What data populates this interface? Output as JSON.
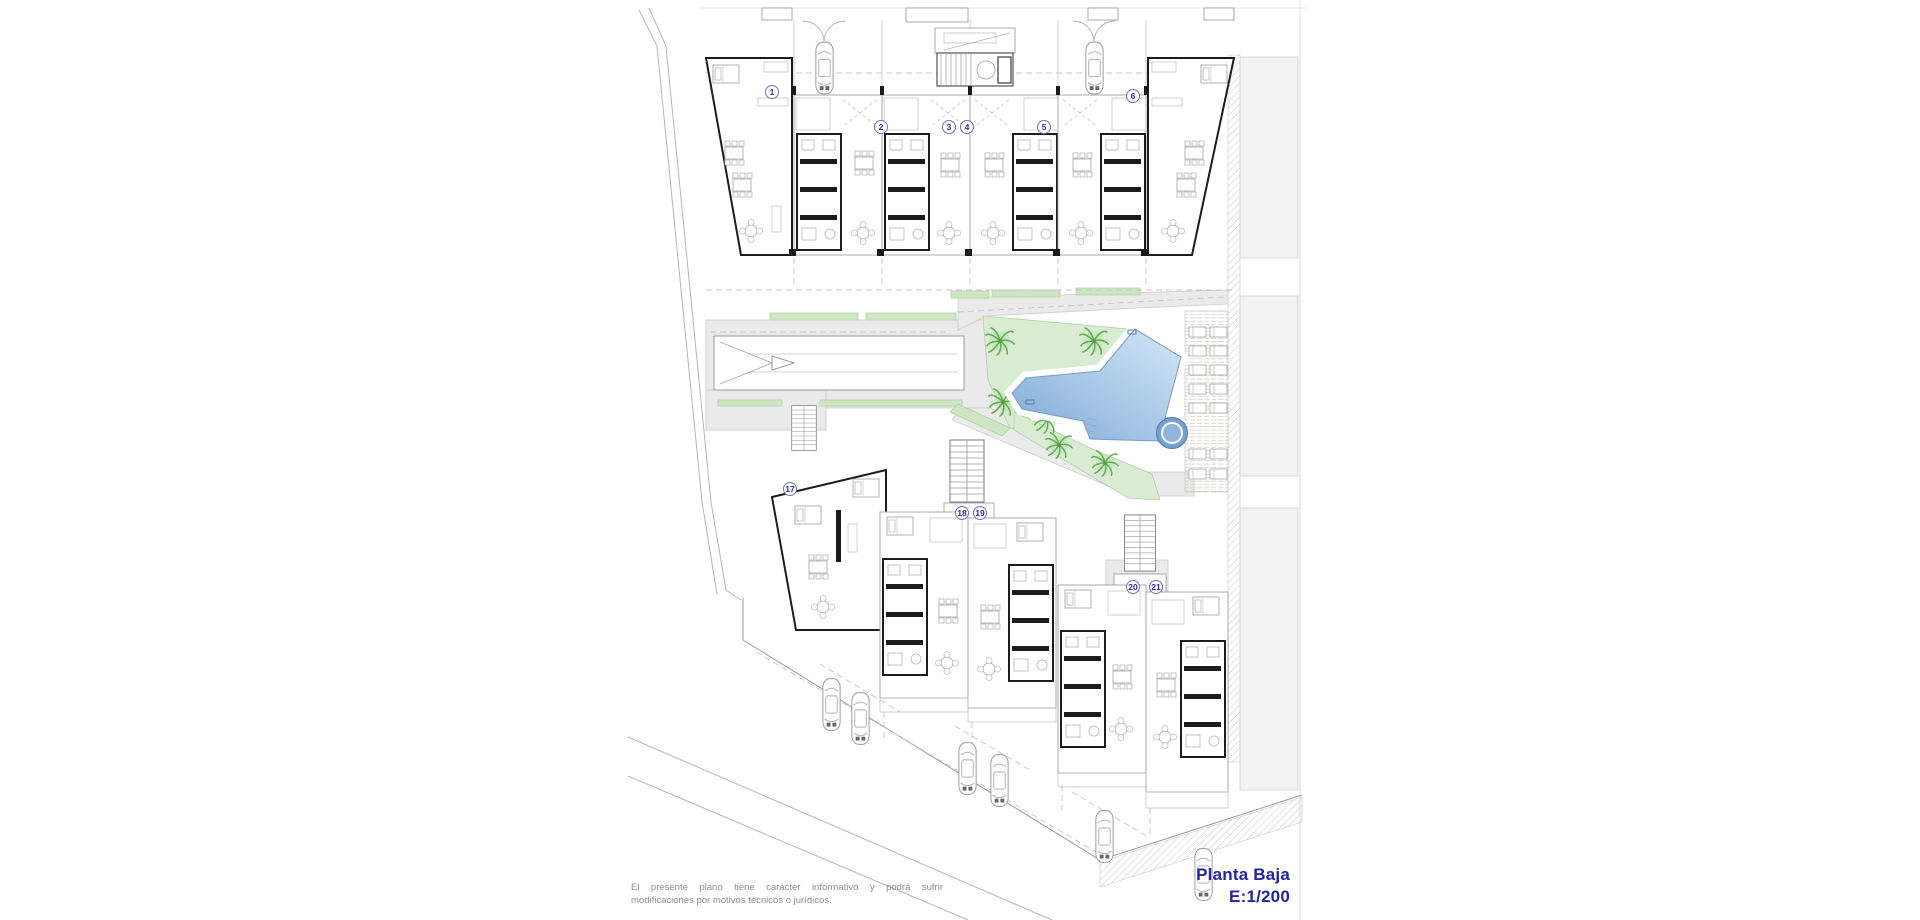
{
  "sheet": {
    "plan_title": "Planta Baja",
    "plan_scale": "E:1/200",
    "disclaimer_line1": "El presente plano tiene carácter informativo y podrá sufrir",
    "disclaimer_line2": "modificaciones por motivos técnicos o jurídicos.",
    "title_color": "#2323a3",
    "disclaimer_color": "#8d8d8d"
  },
  "units": {
    "top_row": [
      "1",
      "2",
      "3",
      "4",
      "5",
      "6"
    ],
    "bottom_row": [
      "17",
      "18",
      "19",
      "20",
      "21"
    ]
  },
  "site": {
    "feature_icons": [
      "swimming-pool",
      "round-spa",
      "sunbathing-deck",
      "garage-ramp",
      "palm-tree",
      "car",
      "staircase",
      "parking-row"
    ],
    "colors": {
      "pool_deep": "#74a3d2",
      "pool_light": "#d3e6f6",
      "landscape_green": "#d9ecd2",
      "strip_green": "#cfe6c4",
      "palm_green": "#6ab35f",
      "path_gray": "#eaeaea"
    }
  }
}
